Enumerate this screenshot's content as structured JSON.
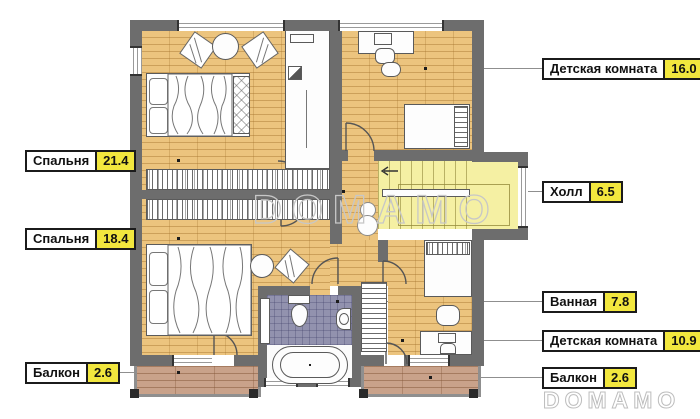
{
  "watermark": {
    "text_center": "DOMAMO",
    "text_corner": "DOMAMO"
  },
  "callouts": {
    "kids_room_large": {
      "label": "Детская комната",
      "area": "16.0"
    },
    "bedroom_large": {
      "label": "Спальня",
      "area": "21.4"
    },
    "hall": {
      "label": "Холл",
      "area": "6.5"
    },
    "bedroom_small": {
      "label": "Спальня",
      "area": "18.4"
    },
    "bathroom": {
      "label": "Ванная",
      "area": "7.8"
    },
    "kids_room_small": {
      "label": "Детская комната",
      "area": "10.9"
    },
    "balcony_left": {
      "label": "Балкон",
      "area": "2.6"
    },
    "balcony_right": {
      "label": "Балкон",
      "area": "2.6"
    }
  },
  "colors": {
    "area_badge": "#f2e73e",
    "wall": "#6d6d6d",
    "wood_floor": "#ecc47e",
    "stair_floor": "#f5f0a3",
    "tile_floor": "#9292ae",
    "balcony_floor": "#c9a28a",
    "watermark": "#c7c7c7"
  }
}
